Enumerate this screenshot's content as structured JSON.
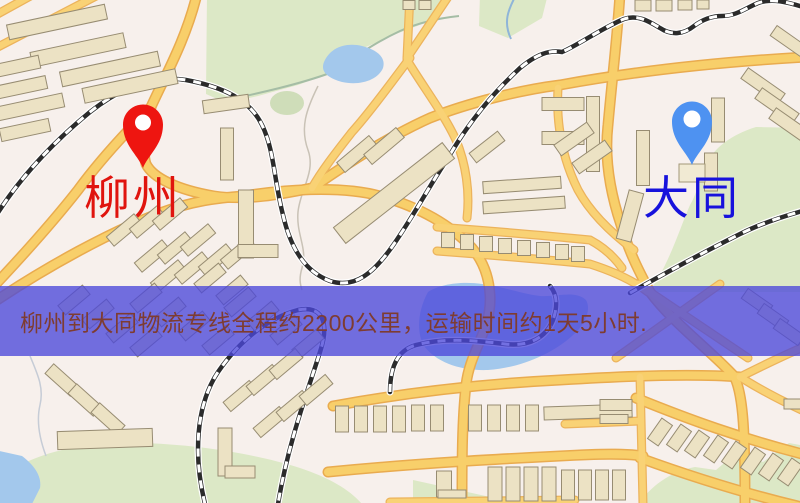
{
  "page": {
    "width": 800,
    "height": 503,
    "kind": "logistics-route-map"
  },
  "map": {
    "style": "stylized-street-map",
    "origin": {
      "label": "柳州",
      "pin_color": "#ee1510",
      "label_color": "#e0140e",
      "pin": "red-location-pin"
    },
    "destination": {
      "label": "大同",
      "pin_color": "#4e92f1",
      "label_color": "#1712dc",
      "pin": "blue-location-pin"
    },
    "feature_colors": {
      "background": "#f7f0ec",
      "road_fill": "#f8cf6a",
      "road_casing": "#e9ab4f",
      "water": "#a3c8ec",
      "park": "#dce8c6",
      "building": "#ece2c4",
      "railway_dark": "#2b2b2b"
    }
  },
  "banner": {
    "text": "柳州到大同物流专线全程约2200公里，运输时间约1天5小时.",
    "bg_color": "rgba(75,72,218,0.78)",
    "text_color": "#7e3c31"
  }
}
